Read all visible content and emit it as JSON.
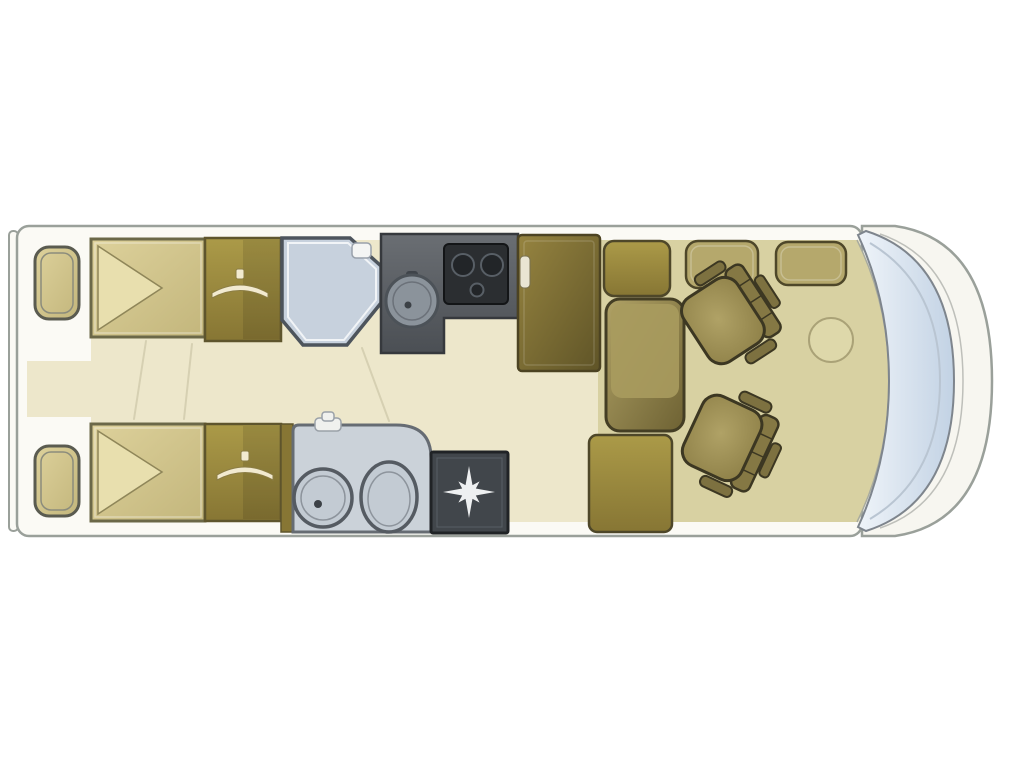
{
  "colors": {
    "background": "#ffffff",
    "body_shell": "#f7f6f0",
    "outline": "#9aa09a",
    "floor_cream": "#ede7cb",
    "floor_khaki": "#d8d1a2",
    "wall_white": "#fbfaf5",
    "bed_light": "#ddd19b",
    "bed_dark": "#c3b67c",
    "bed_border": "#6b6848",
    "pillow": "#e8dfae",
    "wardrobe_light": "#ab9a48",
    "wardrobe_dark": "#877634",
    "wardrobe_border": "#5e552d",
    "hanger": "#f2ead0",
    "shower_pan": "#c7d1dd",
    "shower_border": "#4d545c",
    "counter": "#5d6165",
    "counter_border": "#36393d",
    "stove": "#2b2e31",
    "sink": "#8b939b",
    "fridge_light": "#968440",
    "fridge_dark": "#5f5427",
    "washroom_fill": "#cbd2d9",
    "fixture_fill": "#c3cbd3",
    "fixture_line": "#555b62",
    "tray_fill": "#41464b",
    "star_white": "#eef0f1",
    "seat_light": "#b0a266",
    "seat_mid": "#8a7c44",
    "seat_dark": "#6e6233",
    "seat_border": "#3c3722",
    "windshield_light": "#eff4f9",
    "windshield_blue": "#c2d2e4",
    "table_line": "#aaa277",
    "fold_line": "#d6d0b2",
    "handle": "#e9e5d3"
  },
  "floorplan": {
    "type": "motorhome floor plan",
    "front_end": "right",
    "areas": [
      {
        "name": "rear-bedroom",
        "items": [
          "bedside-cabinet-top",
          "twin-bed-top",
          "wardrobe-top",
          "bedside-cabinet-bottom",
          "twin-bed-bottom",
          "wardrobe-bottom"
        ]
      },
      {
        "name": "washroom",
        "items": [
          "shower-cubicle",
          "washbasin",
          "toilet",
          "shower-tray"
        ]
      },
      {
        "name": "kitchen",
        "items": [
          "worktop",
          "sink",
          "hob",
          "refrigerator"
        ]
      },
      {
        "name": "lounge",
        "items": [
          "overhead-cabinet",
          "sofa-bench",
          "sideboard",
          "seat-cushion-left",
          "seat-cushion-right",
          "swivel-seat-front",
          "swivel-seat-rear",
          "table"
        ]
      },
      {
        "name": "cab",
        "items": [
          "dashboard",
          "windshield"
        ]
      }
    ],
    "icons": {
      "wardrobe": "hanger-icon",
      "shower_tray": "starburst-icon",
      "bed": "pillow-triangle-icon"
    }
  }
}
